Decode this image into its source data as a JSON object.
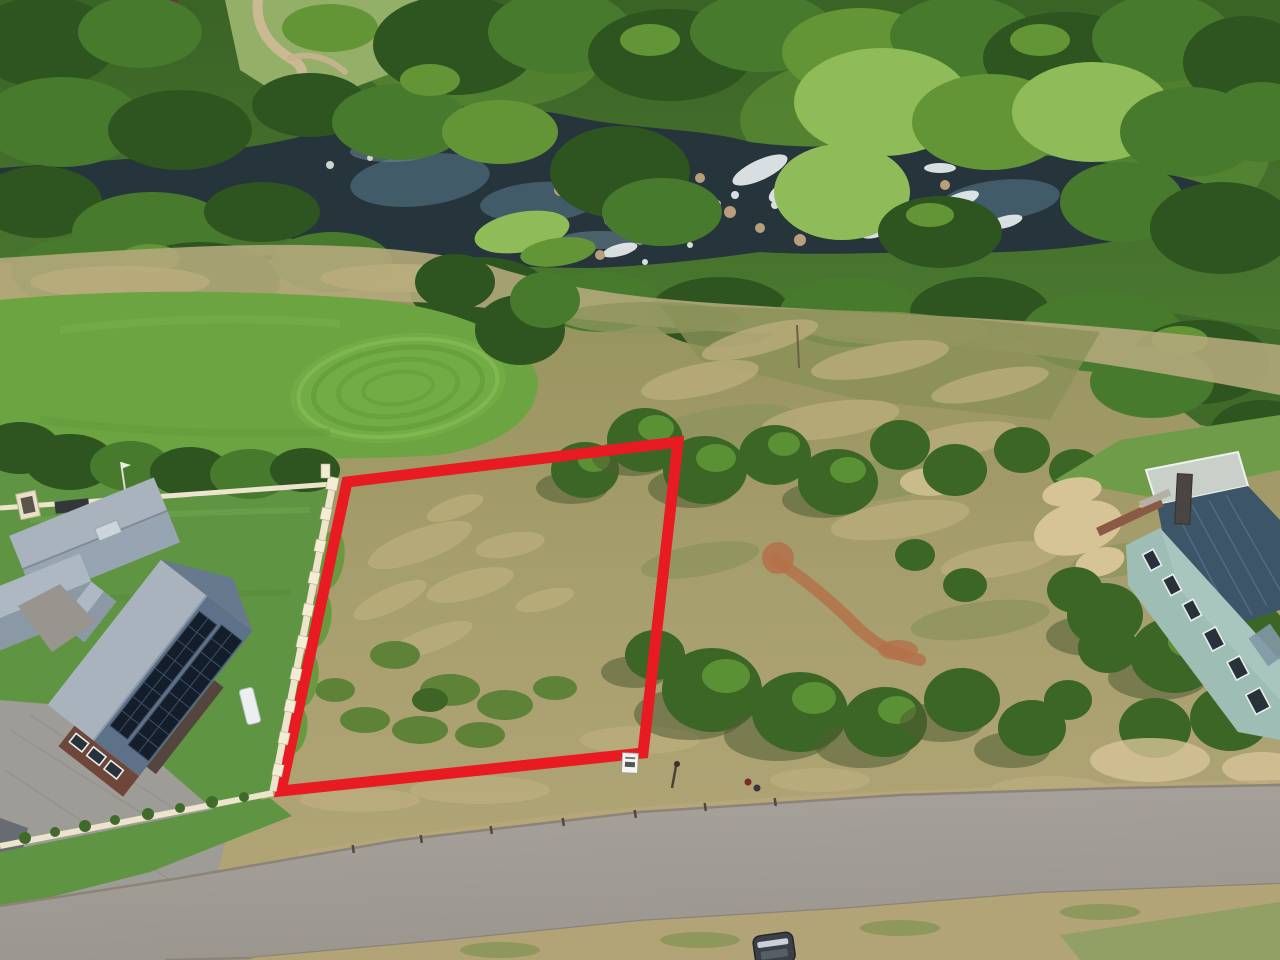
{
  "meta": {
    "alt": "Aerial drone photograph of a vacant grassy residential stand outlined in red, beside a house with rooftop solar panels, a golf green and a rocky river with rapids behind, a curving tar road in front and a teal double-storey house to the right"
  },
  "palette": {
    "outline_red": "#e81b23",
    "river_water": "#26343b",
    "rapids_white": "#e9eef0",
    "forest_dark": "#2e5420",
    "forest_mid": "#477a2d",
    "forest_bright": "#639537",
    "willow_green": "#8fbb58",
    "fairway_green": "#6ba441",
    "ring_green": "#619c3a",
    "rough_olive": "#97945f",
    "rough_tan": "#b3a678",
    "dirt_red": "#b4714a",
    "sand": "#d6c497",
    "road_asphalt": "#a29e97",
    "verge_tan": "#b3a478",
    "roof_silver": "#a9b3bd",
    "roof_slate": "#5d7289",
    "solar_panel": "#141e2b",
    "brick": "#6f463a",
    "cream_wall": "#ece4cc",
    "driveway": "#9e9c96",
    "lawn_green": "#5f9542",
    "teal_wall": "#9dbdb5",
    "teal_roof": "#3d5568",
    "car_body": "#3b4046",
    "sign_white": "#f4f4f0"
  },
  "plot": {
    "points": "347,482 678,442 643,753 281,791",
    "stroke_width": 11
  },
  "scene": {
    "elements": [
      {
        "name": "river",
        "label": "river with rapids and rocks"
      },
      {
        "name": "forest",
        "label": "dense riverside trees and willows"
      },
      {
        "name": "golf-green",
        "label": "golf green with mowing rings"
      },
      {
        "name": "vacant-plot",
        "label": "vacant stand outlined in red"
      },
      {
        "name": "plot-sign",
        "label": "small white stand sign"
      },
      {
        "name": "solar-house",
        "label": "house with grey metal roof and two solar arrays"
      },
      {
        "name": "boundary-wall",
        "label": "cream boundary wall with pillars"
      },
      {
        "name": "driveway",
        "label": "cobbled driveway"
      },
      {
        "name": "street",
        "label": "curving tar road with kerbs"
      },
      {
        "name": "teal-house",
        "label": "teal double-storey house with dark roof"
      },
      {
        "name": "car",
        "label": "car parked on the verge"
      },
      {
        "name": "flag-pole",
        "label": "white flag pole"
      },
      {
        "name": "lamp-post",
        "label": "small street lamp"
      }
    ]
  }
}
